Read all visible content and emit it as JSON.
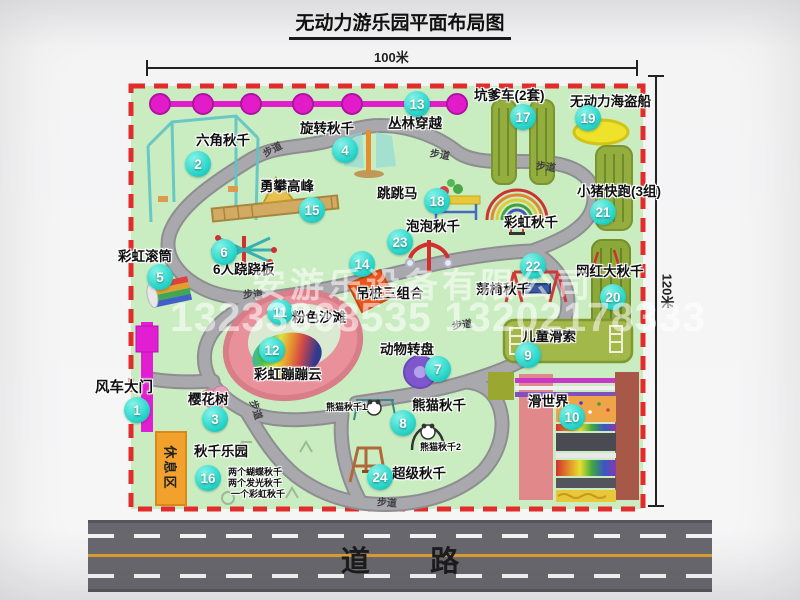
{
  "title": "无动力游乐园平面布局图",
  "dims": {
    "width": "100米",
    "height": "120米"
  },
  "road": {
    "label": "道 路"
  },
  "walkway_label": "步道",
  "rest_area_label": "休息区",
  "rainbow_swing_label": "彩虹秋千",
  "watermark": {
    "company": "安游乐设备有限公司",
    "phone": "13233868535 13202178333"
  },
  "attractions": [
    {
      "num": "1",
      "label": "风车大门"
    },
    {
      "num": "2",
      "label": "六角秋千"
    },
    {
      "num": "3",
      "label": "樱花树"
    },
    {
      "num": "4",
      "label": "旋转秋千"
    },
    {
      "num": "5",
      "label": "彩虹滚筒"
    },
    {
      "num": "6",
      "label": "6人跷跷板"
    },
    {
      "num": "7",
      "label": "动物转盘"
    },
    {
      "num": "8",
      "label": "熊猫秋千"
    },
    {
      "num": "9",
      "label": "儿童滑索"
    },
    {
      "num": "10",
      "label": "滑世界"
    },
    {
      "num": "11",
      "label": "粉色沙滩"
    },
    {
      "num": "12",
      "label": "彩虹蹦蹦云"
    },
    {
      "num": "13",
      "label": "丛林穿越"
    },
    {
      "num": "14",
      "label": "吊桩三组合"
    },
    {
      "num": "15",
      "label": "勇攀高峰"
    },
    {
      "num": "16",
      "label": "秋千乐园"
    },
    {
      "num": "17",
      "label": "坑爹车(2套)"
    },
    {
      "num": "18",
      "label": "跳跳马"
    },
    {
      "num": "19",
      "label": "无动力海盗船"
    },
    {
      "num": "20",
      "label": "网红大秋千"
    },
    {
      "num": "21",
      "label": "小猪快跑(3组)"
    },
    {
      "num": "22",
      "label": "荡椅秋千"
    },
    {
      "num": "23",
      "label": "泡泡秋千"
    },
    {
      "num": "24",
      "label": "超级秋千"
    }
  ],
  "swing_park_notes": [
    "两个蝴蝶秋千",
    "两个发光秋千",
    "一个彩虹秋千"
  ],
  "panda_notes": [
    "熊猫秋千1",
    "熊猫秋千2"
  ],
  "colors": {
    "park_green": "#c9edc1",
    "path_gray": "#a4a4a8",
    "marker_teal": "#2ad6ca",
    "border_red": "#e22b2b",
    "magenta": "#e11ec9",
    "road_gray": "#67676d",
    "strip_olive": "#93ad3e",
    "beach_pink": "#e8919b"
  }
}
